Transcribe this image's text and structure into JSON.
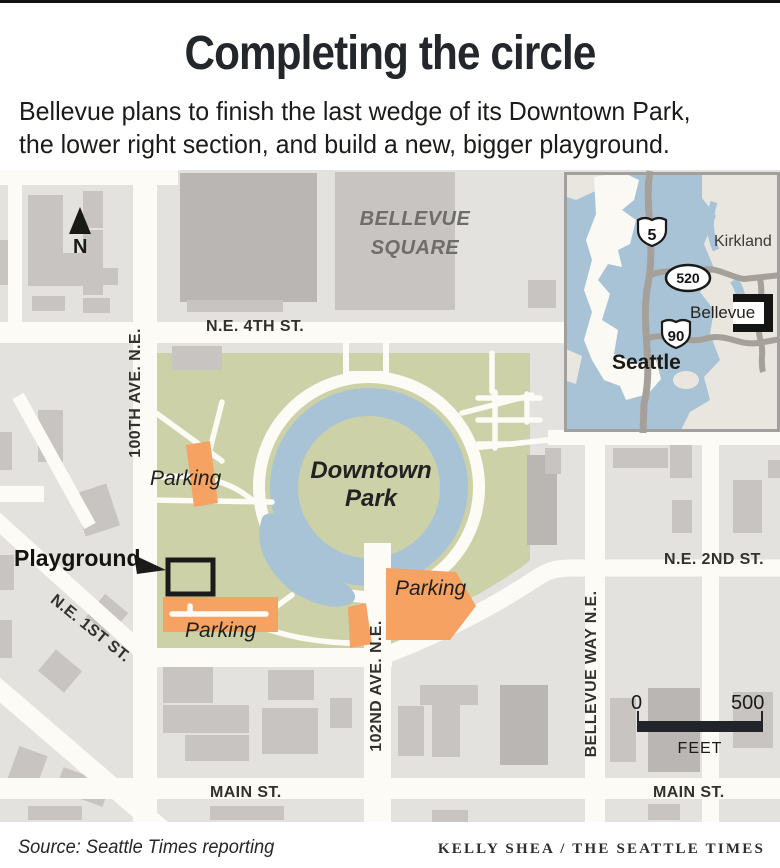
{
  "header": {
    "title": "Completing the circle",
    "subtitle1": "Bellevue plans to finish the last wedge of its Downtown Park,",
    "subtitle2": "the lower right section, and build a new, bigger playground."
  },
  "map": {
    "north": "N",
    "streets": {
      "ne4th": "N.E. 4TH ST.",
      "ave100": "100TH AVE. N.E.",
      "ne2nd": "N.E. 2ND ST.",
      "ne1st": "N.E. 1ST ST.",
      "ave102": "102ND AVE. N.E.",
      "bellevue_way": "BELLEVUE WAY N.E.",
      "main_w": "MAIN ST.",
      "main_e": "MAIN ST."
    },
    "areas": {
      "bellevue_square_1": "BELLEVUE",
      "bellevue_square_2": "SQUARE",
      "park_1": "Downtown",
      "park_2": "Park"
    },
    "parking": {
      "p1": "Parking",
      "p2": "Parking",
      "p3": "Parking"
    },
    "playground": "Playground"
  },
  "inset": {
    "cities": {
      "kirkland": "Kirkland",
      "bellevue": "Bellevue",
      "seattle": "Seattle"
    },
    "routes": {
      "i5": "5",
      "sr520": "520",
      "i90": "90"
    }
  },
  "scale": {
    "zero": "0",
    "max": "500",
    "unit": "FEET"
  },
  "credits": {
    "source": "Source: Seattle Times reporting",
    "byline": "KELLY SHEA / THE SEATTLE TIMES"
  },
  "colors": {
    "bg": "#e4e2df",
    "street": "#fcfbf5",
    "building": "#c7c4c1",
    "building_dark": "#b9b6b3",
    "park": "#cdd1a7",
    "water": "#a9c3d6",
    "parking": "#f5a263",
    "ink": "#1c1c1a",
    "label_gray": "#6f6d6a",
    "inset_land_east": "#e9e6e0",
    "inset_land_west": "#fbf9f3",
    "inset_road": "#a5a09a"
  }
}
